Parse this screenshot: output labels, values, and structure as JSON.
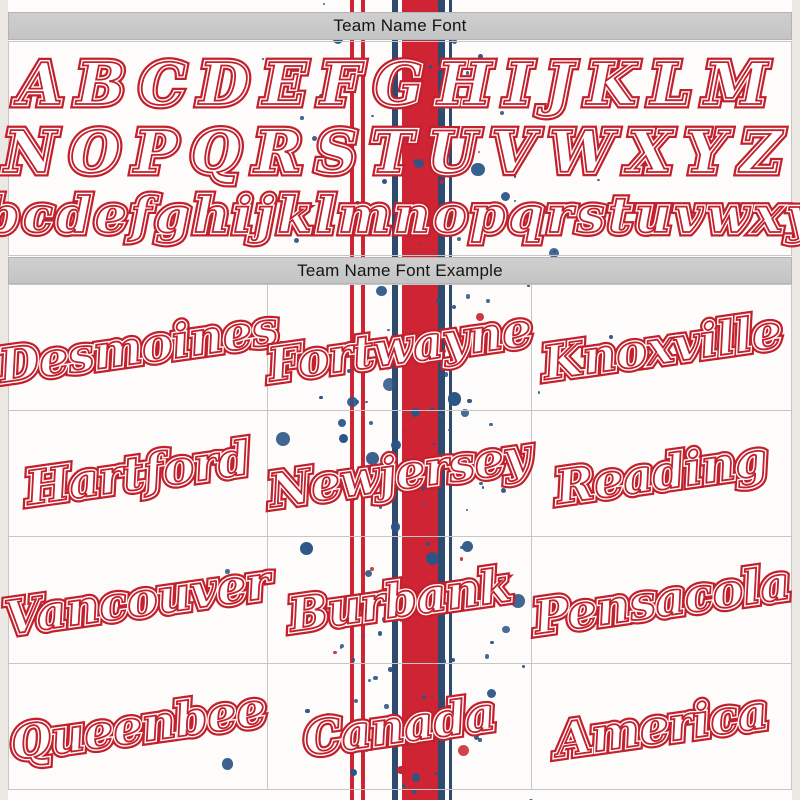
{
  "headers": {
    "font_section": "Team Name Font",
    "example_section": "Team Name Font Example"
  },
  "alphabet": {
    "uppercase_1": "ABCDEFGHIJKLM",
    "uppercase_2": "NOPQRSTUVWXYZ",
    "lowercase": "abcdefghijklmnopqrstuvwxyz"
  },
  "examples": {
    "cells": [
      "Desmoines",
      "Fortwayne",
      "Knoxville",
      "Hartford",
      "Newjersey",
      "Reading",
      "Vancouver",
      "Burbank",
      "Pensacola",
      "Queenbee",
      "Canada",
      "America"
    ]
  },
  "colors": {
    "script_red": "#c2202c",
    "stripe_red": "#ce2433",
    "stripe_navy": "#2e4a6e",
    "splatter_blue": "#2b5586",
    "splatter_red": "#c8242e",
    "header_bg": "#c9c9c9",
    "header_text": "#141414"
  },
  "decor": {
    "splatter_primary": "#2b5586",
    "splatter_accent": "#c8242e",
    "splatter_count": 170
  }
}
